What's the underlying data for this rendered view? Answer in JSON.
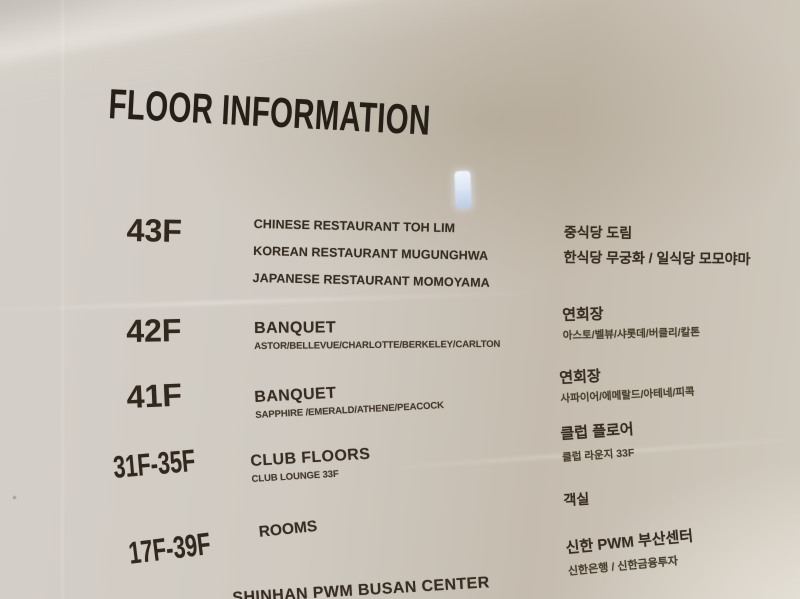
{
  "sign": {
    "title": "FLOOR INFORMATION",
    "rows": [
      {
        "floor": "43F",
        "en_lines": [
          "CHINESE RESTAURANT TOH LIM",
          "KOREAN RESTAURANT MUGUNGHWA",
          "JAPANESE RESTAURANT MOMOYAMA"
        ],
        "ko_lines": [
          "중식당 도림",
          "한식당 무궁화 / 일식당 모모야마"
        ]
      },
      {
        "floor": "42F",
        "en_title": "BANQUET",
        "en_sub": "ASTOR/BELLEVUE/CHARLOTTE/BERKELEY/CARLTON",
        "ko_title": "연회장",
        "ko_sub": "아스토/벨뷰/샤롯데/버클리/칼톤"
      },
      {
        "floor": "41F",
        "en_title": "BANQUET",
        "en_sub": "SAPPHIRE /EMERALD/ATHENE/PEACOCK",
        "ko_title": "연회장",
        "ko_sub": "사파이어/에메랄드/아테네/피콕"
      },
      {
        "floor": "31F-35F",
        "en_title": "CLUB FLOORS",
        "en_sub": "CLUB LOUNGE 33F",
        "ko_title": "클럽 플로어",
        "ko_sub": "클럽 라운지 33F"
      },
      {
        "floor": "17F-39F",
        "en_title": "ROOMS",
        "ko_title": "객실"
      },
      {
        "en_title": "SHINHAN PWM BUSAN CENTER",
        "en_sub": "SHINHAN BANK / SHINHAN INVESTMENT",
        "ko_title": "신한 PWM 부산센터",
        "ko_sub": "신한은행 / 신한금융투자"
      }
    ],
    "colors": {
      "text_dark": "#372d22",
      "title": "#251f18",
      "sign_background": "#cdc6ba",
      "glare_blue": "#dce7f5"
    }
  }
}
